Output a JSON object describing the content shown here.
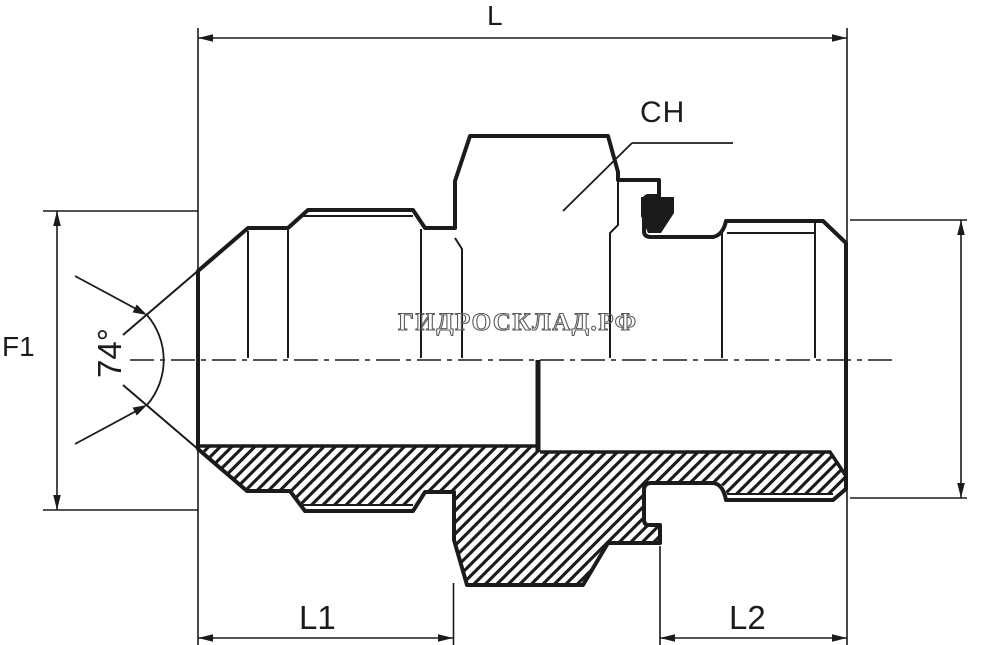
{
  "title": "hydraulic-adapter-technical-drawing",
  "labels": {
    "total_length": "L",
    "hex_size": "CH",
    "flare_diameter": "F1",
    "cone_angle": "74°",
    "left_length": "L1",
    "right_length": "L2"
  },
  "watermark": {
    "text": "ГИДРОСКЛАД.РФ"
  },
  "colors": {
    "line": "#1b1b1b",
    "background": "#ffffff",
    "watermark_outline": "#5a5a5a"
  }
}
